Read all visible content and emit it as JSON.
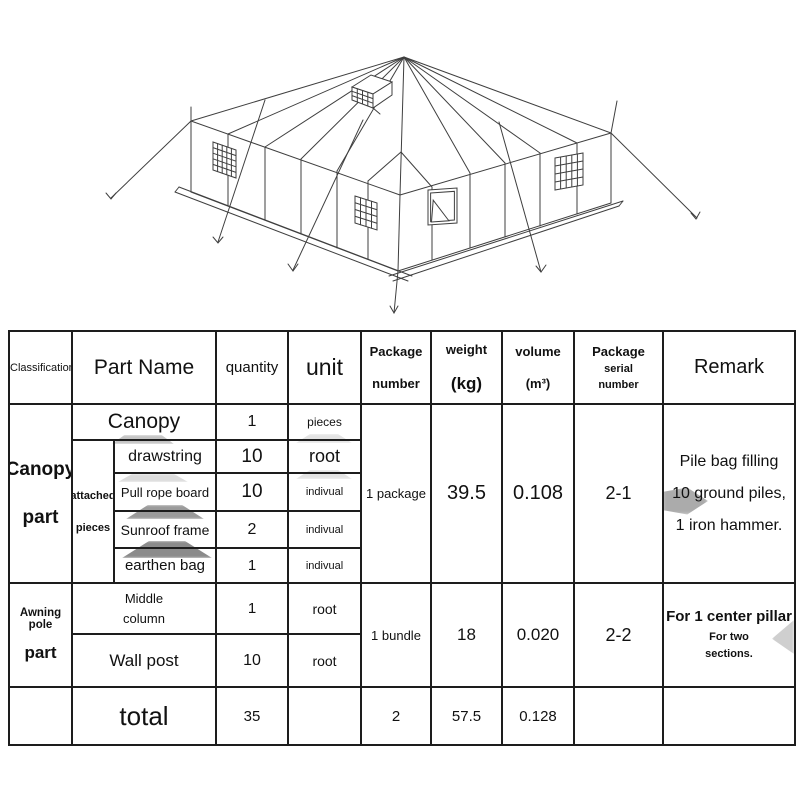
{
  "figure": {
    "name": "relief-tent-isometric-line-drawing"
  },
  "table": {
    "header": {
      "classification": "Classification",
      "part_name": "Part Name",
      "quantity": "quantity",
      "unit": "unit",
      "package_number": [
        "Package",
        "number"
      ],
      "weight": [
        "weight",
        "(kg)"
      ],
      "volume": [
        "volume",
        "(m³)"
      ],
      "package_serial": [
        "Package",
        "serial",
        "number"
      ],
      "remark": "Remark"
    },
    "groups": [
      {
        "classification": [
          "Canopy",
          "part"
        ],
        "sub_label": [
          "attached",
          "pieces"
        ],
        "rows": [
          {
            "part": "Canopy",
            "qty": "1",
            "unit": "pieces"
          },
          {
            "part": "drawstring",
            "qty": "10",
            "unit": "root"
          },
          {
            "part": "Pull rope board",
            "qty": "10",
            "unit": "indivual"
          },
          {
            "part": "Sunroof frame",
            "qty": "2",
            "unit": "indivual"
          },
          {
            "part": "earthen bag",
            "qty": "1",
            "unit": "indivual"
          }
        ],
        "package_number": "1 package",
        "weight": "39.5",
        "volume": "0.108",
        "serial": "2-1",
        "remark": [
          "Pile bag filling",
          "10 ground piles,",
          "1 iron hammer."
        ]
      },
      {
        "classification": [
          "Awning pole",
          "part"
        ],
        "rows": [
          {
            "part": [
              "Middle",
              "column"
            ],
            "qty": "1",
            "unit": "root"
          },
          {
            "part": "Wall post",
            "qty": "10",
            "unit": "root"
          }
        ],
        "package_number": "1 bundle",
        "weight": "18",
        "volume": "0.020",
        "serial": "2-2",
        "remark_main": "For 1 center pillar",
        "remark_sub": [
          "For two",
          "sections."
        ]
      }
    ],
    "total": {
      "label": "total",
      "qty": "35",
      "package_number": "2",
      "weight": "57.5",
      "volume": "0.128"
    }
  }
}
